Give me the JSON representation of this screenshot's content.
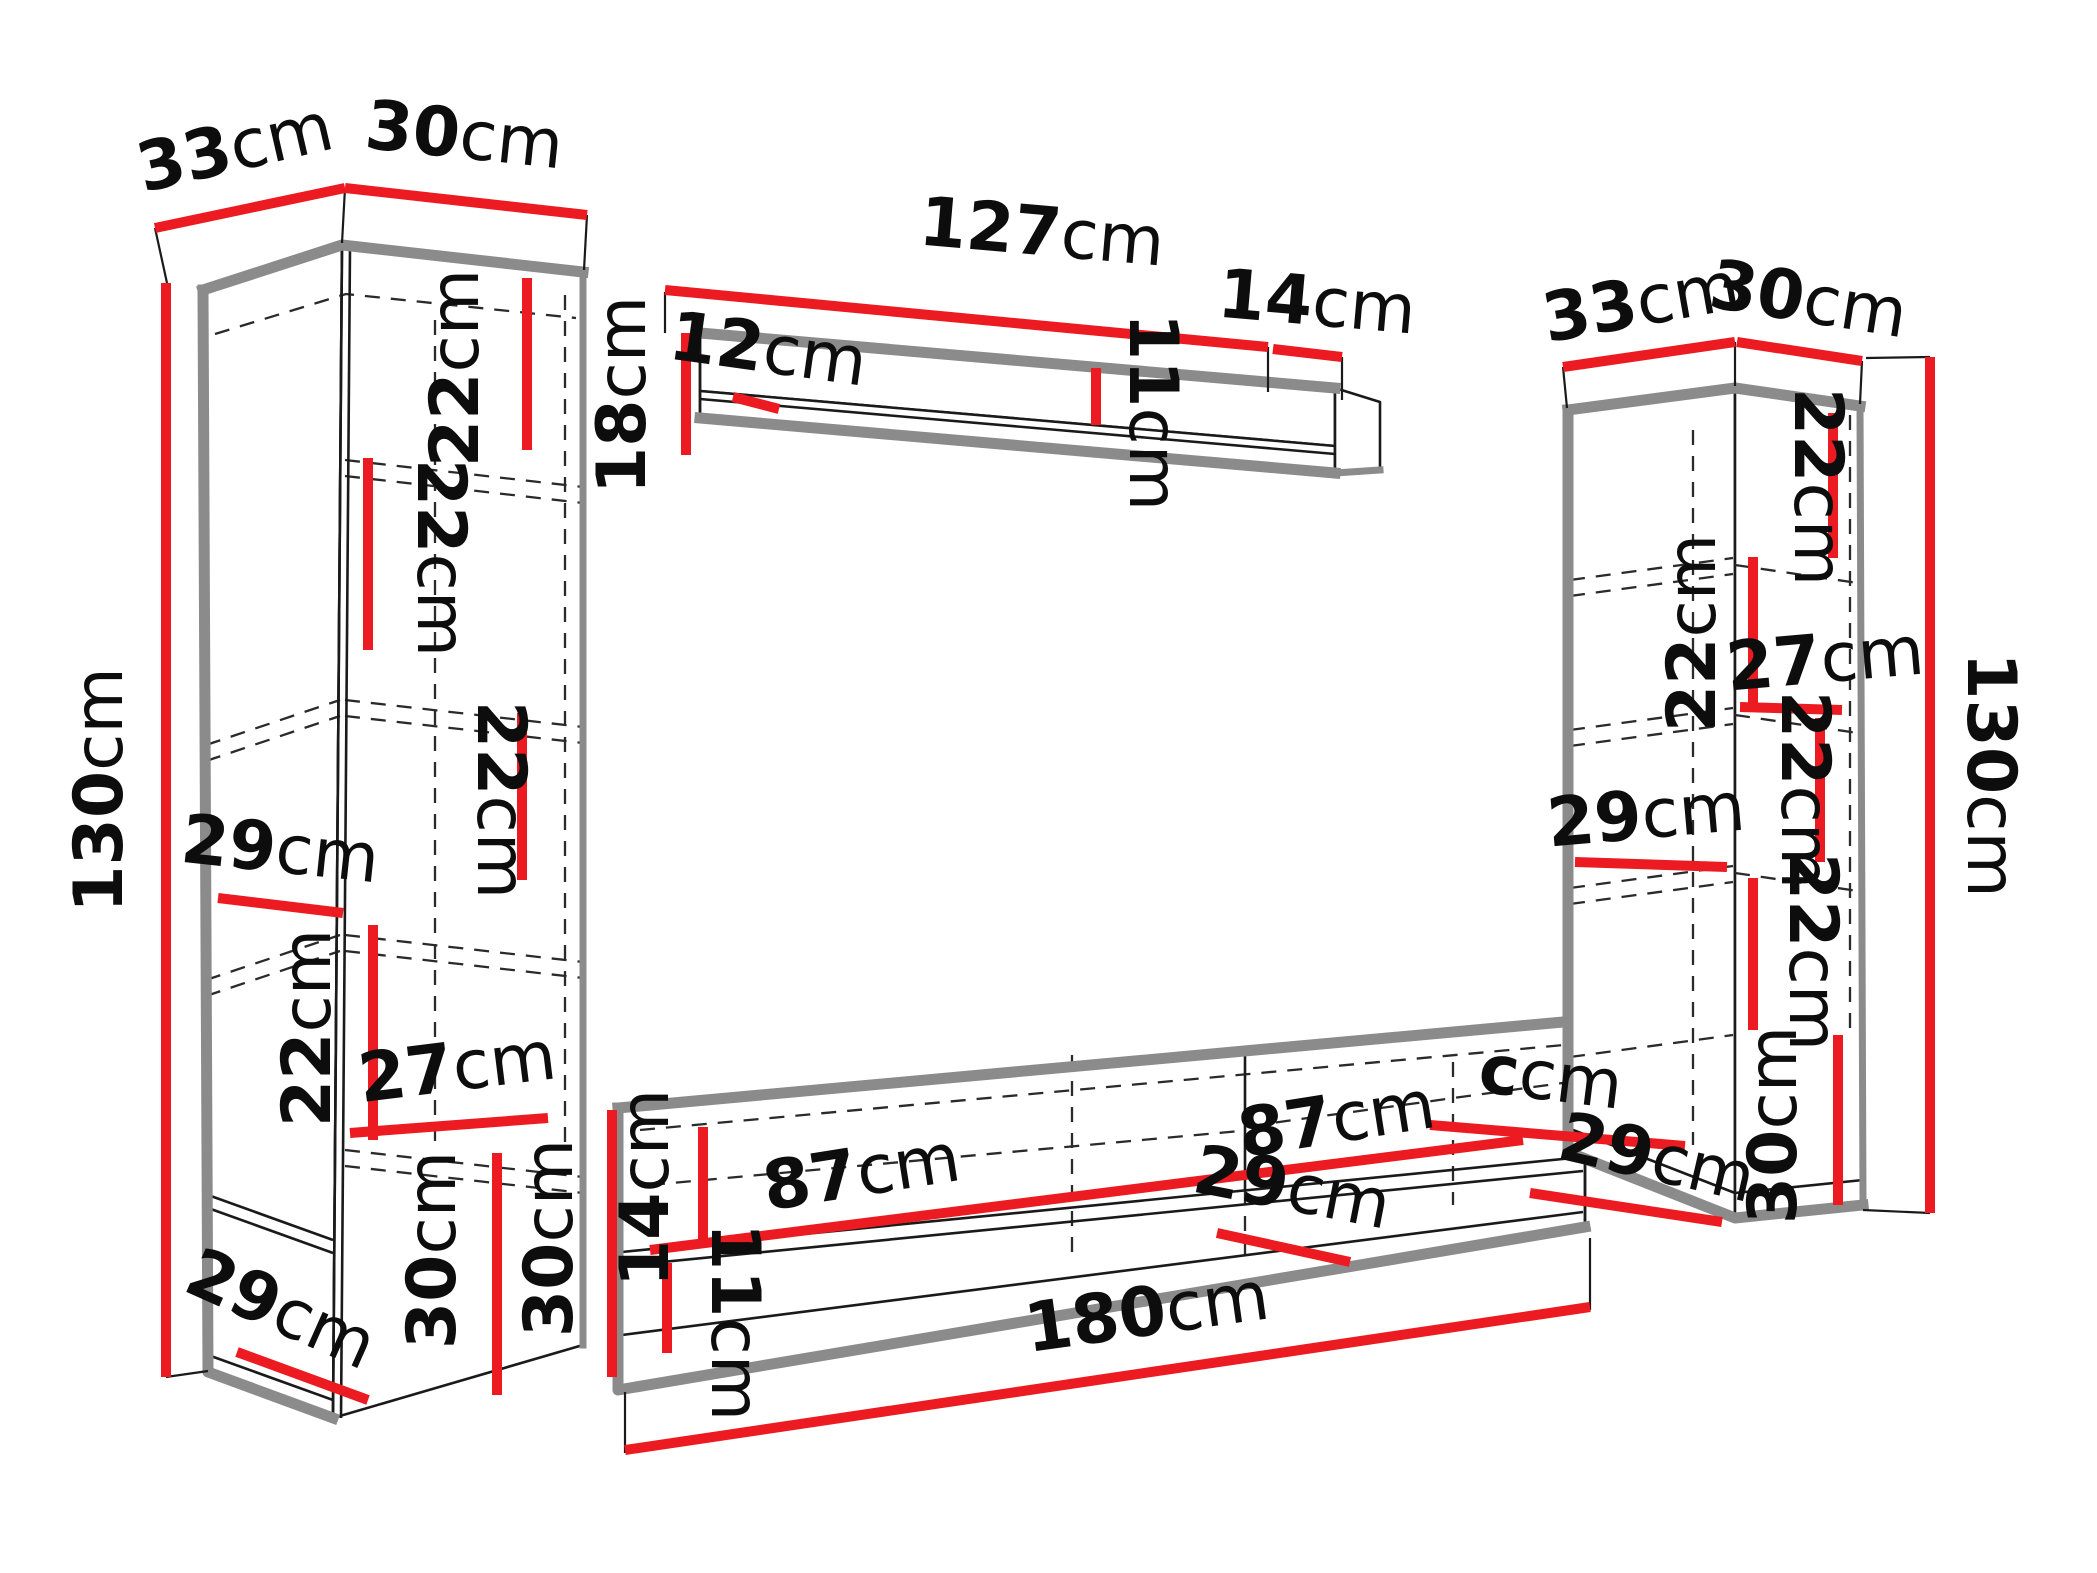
{
  "diagram": {
    "type": "furniture-dimension-diagram",
    "pieces": [
      "left-tall-cabinet",
      "wall-shelf",
      "right-tall-cabinet",
      "tv-stand"
    ],
    "unit": "cm",
    "colors": {
      "dimension": "#ec1b21",
      "outline": "#1a1a1a",
      "edge": "#8b8b8b",
      "text": "#0d0d0d",
      "background": "#ffffff"
    }
  },
  "labels": {
    "lc_depth": {
      "num": "33",
      "unit": "cm"
    },
    "lc_width": {
      "num": "30",
      "unit": "cm"
    },
    "lc_height": {
      "num": "130",
      "unit": "cm"
    },
    "lc_gap1": {
      "num": "22",
      "unit": "cm"
    },
    "lc_gap2": {
      "num": "22",
      "unit": "cm"
    },
    "lc_gap3": {
      "num": "22",
      "unit": "cm"
    },
    "lc_gap4": {
      "num": "22",
      "unit": "cm"
    },
    "lc_shelf_depth": {
      "num": "29",
      "unit": "cm"
    },
    "lc_inner_width": {
      "num": "27",
      "unit": "cm"
    },
    "lc_bottom_height": {
      "num": "30",
      "unit": "cm"
    },
    "lc_bottom_depth": {
      "num": "29",
      "unit": "cm"
    },
    "ws_length": {
      "num": "127",
      "unit": "cm"
    },
    "ws_end_depth": {
      "num": "14",
      "unit": "cm"
    },
    "ws_height": {
      "num": "18",
      "unit": "cm"
    },
    "ws_side_depth": {
      "num": "12",
      "unit": "cm"
    },
    "ws_back_height": {
      "num": "11",
      "unit": "cm"
    },
    "tv_height": {
      "num": "30",
      "unit": "cm"
    },
    "tv_front_height": {
      "num": "14",
      "unit": "cm"
    },
    "tv_open_height": {
      "num": "11",
      "unit": "cm"
    },
    "tv_comp_left": {
      "num": "87",
      "unit": "cm"
    },
    "tv_comp_right": {
      "num": "87",
      "unit": "cm"
    },
    "tv_shelf_depth": {
      "num": "29",
      "unit": "cm"
    },
    "tv_glitch": {
      "num": "c",
      "unit": "cm"
    },
    "tv_end_depth": {
      "num": "29",
      "unit": "cm"
    },
    "tv_length": {
      "num": "180",
      "unit": "cm"
    },
    "rc_depth": {
      "num": "33",
      "unit": "cm"
    },
    "rc_width": {
      "num": "30",
      "unit": "cm"
    },
    "rc_height": {
      "num": "130",
      "unit": "cm"
    },
    "rc_gap1": {
      "num": "22",
      "unit": "cm"
    },
    "rc_gap2": {
      "num": "22",
      "unit": "cm"
    },
    "rc_gap3": {
      "num": "22",
      "unit": "cm"
    },
    "rc_gap4": {
      "num": "22",
      "unit": "cm"
    },
    "rc_inner_width": {
      "num": "27",
      "unit": "cm"
    },
    "rc_shelf_depth": {
      "num": "29",
      "unit": "cm"
    },
    "rc_bottom_height": {
      "num": "30",
      "unit": "cm"
    }
  }
}
